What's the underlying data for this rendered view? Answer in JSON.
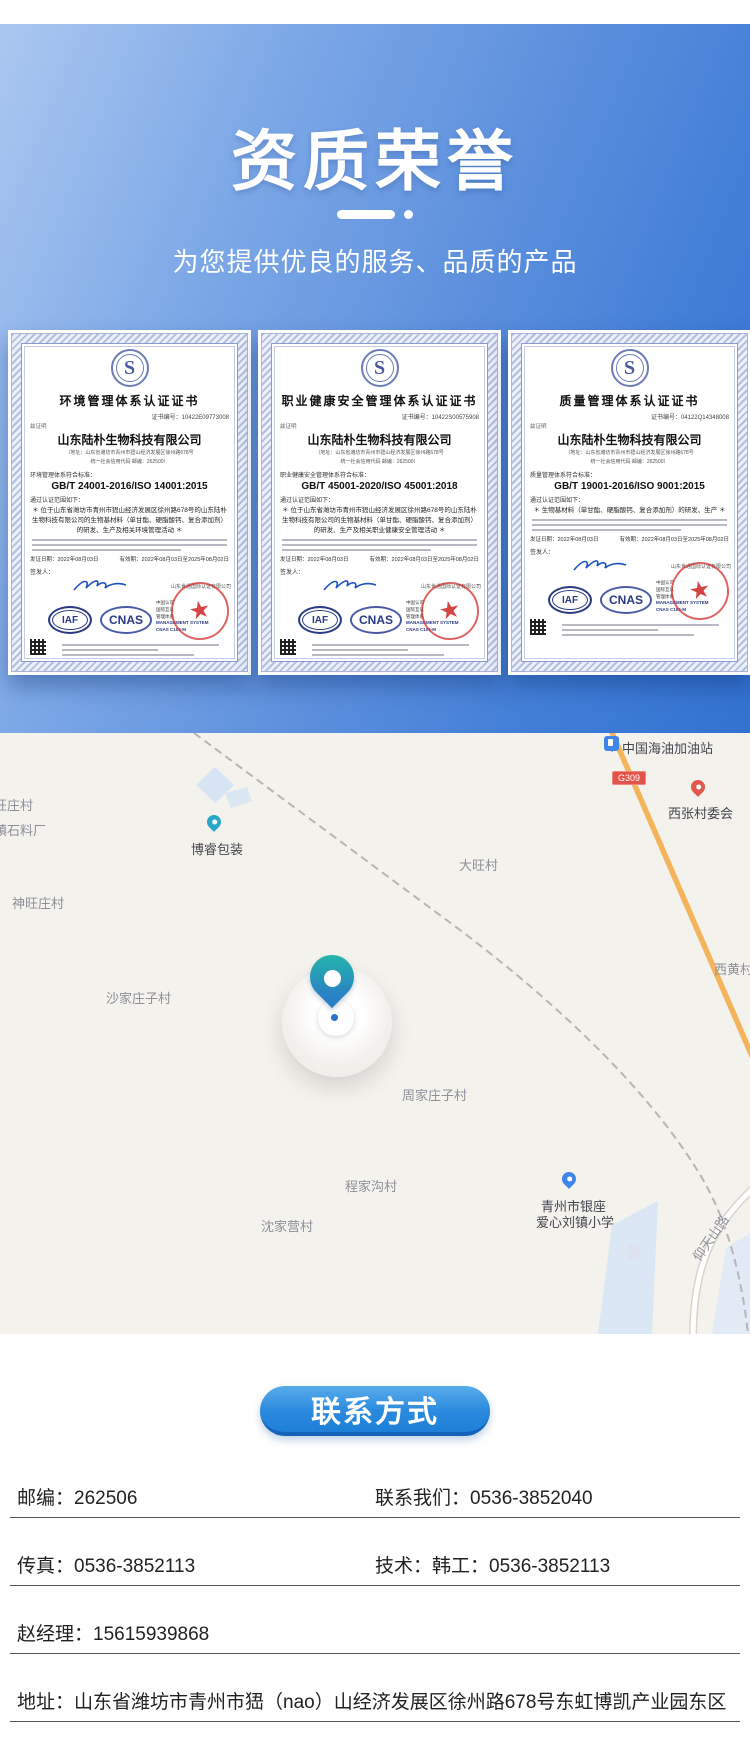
{
  "header": {
    "title": "资质荣誉",
    "subtitle": "为您提供优良的服务、品质的产品",
    "accent_color": "#3372d0"
  },
  "cert_labels": {
    "attest": "兹证明"
  },
  "certificates": [
    {
      "title": "环境管理体系认证证书",
      "cert_no": "证书编号：10422E09773008",
      "company": "山东陆朴生物科技有限公司",
      "addr1": "（地址：山东省潍坊市青州市峱山经济发展区徐州路678号",
      "addr2": "统一社会信用代码 邮编：262500）",
      "std_label": "环境管理体系符合标准：",
      "standard": "GB/T 24001-2016/ISO 14001:2015",
      "scope_intro": "通过认证范围如下：",
      "scope": "＊ 位于山东省潍坊市青州市峱山经济发展区徐州路678号的山东陆朴生物科技有限公司的生物基材料（单甘酯、硬脂酸钙、复合添加剂）的研发、生产及相关环境管理活动 ＊",
      "issue_date": "发证日期：2022年08月03日",
      "valid_until": "有效期：2022年08月03日至2025年08月02日",
      "signer_label": "签发人：",
      "issuer": "山东世通国际认证有限公司",
      "iaf_label": "IAF",
      "cnas_label": "CNAS",
      "accred_line1": "中国认可",
      "accred_line2": "国际互认",
      "accred_line3": "管理体系",
      "mgmt_line": "MANAGEMENT SYSTEM",
      "cnas_code": "CNAS C104-M",
      "logo_letter": "S"
    },
    {
      "title": "职业健康安全管理体系认证证书",
      "cert_no": "证书编号：10422S00575908",
      "company": "山东陆朴生物科技有限公司",
      "addr1": "（地址：山东省潍坊市青州市峱山经济发展区徐州路678号",
      "addr2": "统一社会信用代码 邮编：262500）",
      "std_label": "职业健康安全管理体系符合标准：",
      "standard": "GB/T 45001-2020/ISO 45001:2018",
      "scope_intro": "通过认证范围如下：",
      "scope": "＊ 位于山东省潍坊市青州市峱山经济发展区徐州路678号的山东陆朴生物科技有限公司的生物基材料（单甘酯、硬脂酸钙、复合添加剂）的研发、生产及相关职业健康安全管理活动 ＊",
      "issue_date": "发证日期：2022年08月03日",
      "valid_until": "有效期：2022年08月03日至2025年08月02日",
      "signer_label": "签发人：",
      "issuer": "山东世通国际认证有限公司",
      "iaf_label": "IAF",
      "cnas_label": "CNAS",
      "accred_line1": "中国认可",
      "accred_line2": "国际互认",
      "accred_line3": "管理体系",
      "mgmt_line": "MANAGEMENT SYSTEM",
      "cnas_code": "CNAS C104-M",
      "logo_letter": "S"
    },
    {
      "title": "质量管理体系认证证书",
      "cert_no": "证书编号：04122Q14348008",
      "company": "山东陆朴生物科技有限公司",
      "addr1": "（地址：山东省潍坊市青州市峱山经济发展区徐州路678号",
      "addr2": "统一社会信用代码 邮编：262500）",
      "std_label": "质量管理体系符合标准：",
      "standard": "GB/T 19001-2016/ISO 9001:2015",
      "scope_intro": "通过认证范围如下：",
      "scope": "＊ 生物基材料（单甘酯、硬脂酸钙、复合添加剂）的研发、生产 ＊",
      "issue_date": "发证日期：2022年08月03日",
      "valid_until": "有效期：2022年08月03日至2025年08月02日",
      "signer_label": "签发人：",
      "issuer": "山东世通国际认证有限公司",
      "iaf_label": "IAF",
      "cnas_label": "CNAS",
      "accred_line1": "中国认可",
      "accred_line2": "国际互认",
      "accred_line3": "管理体系",
      "mgmt_line": "MANAGEMENT SYSTEM",
      "cnas_code": "CNAS C104-M",
      "logo_letter": "S"
    }
  ],
  "map": {
    "labels": [
      {
        "text": "中国海油加油站",
        "x": 622,
        "y": 5,
        "cls": "poi"
      },
      {
        "text": "G309",
        "x": 612,
        "y": 38,
        "cls": "badge"
      },
      {
        "text": "西张村委会",
        "x": 668,
        "y": 70,
        "cls": "poi"
      },
      {
        "text": "旺庄村",
        "x": -6,
        "y": 62,
        "cls": "village"
      },
      {
        "text": "镇石料厂",
        "x": -6,
        "y": 87,
        "cls": "village"
      },
      {
        "text": "博睿包装",
        "x": 191,
        "y": 106,
        "cls": "poi"
      },
      {
        "text": "大旺村",
        "x": 459,
        "y": 122,
        "cls": "village"
      },
      {
        "text": "神旺庄村",
        "x": 12,
        "y": 160,
        "cls": "village"
      },
      {
        "text": "西黄村",
        "x": 714,
        "y": 226,
        "cls": "village"
      },
      {
        "text": "沙家庄子村",
        "x": 106,
        "y": 255,
        "cls": "village"
      },
      {
        "text": "周家庄子村",
        "x": 402,
        "y": 352,
        "cls": "village"
      },
      {
        "text": "程家沟村",
        "x": 345,
        "y": 443,
        "cls": "village"
      },
      {
        "text": "青州市银座",
        "x": 541,
        "y": 463,
        "cls": "poi"
      },
      {
        "text": "爱心刘镇小学",
        "x": 536,
        "y": 479,
        "cls": "poi"
      },
      {
        "text": "沈家营村",
        "x": 261,
        "y": 483,
        "cls": "village"
      },
      {
        "text": "仰天山路",
        "x": 684,
        "y": 495,
        "cls": "village road-label"
      }
    ],
    "icons": [
      {
        "name": "gas-station-icon",
        "x": 604,
        "y": 3,
        "cls": "icon-gas"
      },
      {
        "name": "village-committee-icon",
        "x": 691,
        "y": 47,
        "cls": "icon-pin red"
      },
      {
        "name": "borui-packaging-icon",
        "x": 207,
        "y": 82,
        "cls": "icon-pin teal"
      },
      {
        "name": "school-icon",
        "x": 562,
        "y": 439,
        "cls": "icon-pin blue"
      }
    ],
    "road_badge_color": "#e25449",
    "highway_color": "#f3b45c"
  },
  "contact": {
    "button_label": "联系方式",
    "rows": [
      {
        "left": "邮编：262506",
        "right": "联系我们：0536-3852040"
      },
      {
        "left": "传真：0536-3852113",
        "right": "技术：韩工：0536-3852113"
      },
      {
        "left": "赵经理：15615939868",
        "right": ""
      },
      {
        "left": "地址：山东省潍坊市青州市峱（nao）山经济发展区徐州路678号东虹博凯产业园东区",
        "right": ""
      }
    ]
  }
}
